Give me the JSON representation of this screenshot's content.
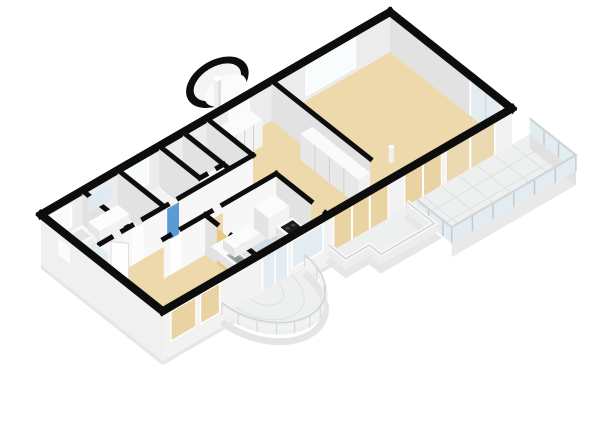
{
  "scene": {
    "type": "floorplan-3d-render",
    "background": "#ffffff",
    "rooms": [
      {
        "id": "living-room",
        "floor": "floor_tan"
      },
      {
        "id": "entry-hall",
        "floor": "floor_tan"
      },
      {
        "id": "corridor",
        "floor": "floor_tan"
      },
      {
        "id": "bedroom-sw",
        "floor": "floor_tan"
      },
      {
        "id": "bathroom",
        "floor": "floor_blue"
      },
      {
        "id": "toilet-room",
        "floor": "floor_white"
      },
      {
        "id": "bedroom-nw",
        "floor": "floor_white"
      },
      {
        "id": "vestibule",
        "floor": "floor_white"
      },
      {
        "id": "storage-room",
        "floor": "floor_dark"
      },
      {
        "id": "kitchen",
        "floor": "floor_blue"
      }
    ],
    "features": [
      "round-turret-balcony",
      "glass-railing-terrace",
      "stepped-terrace",
      "semicircular-balcony",
      "bathtub",
      "shower",
      "vanity",
      "kitchen-counter",
      "sink",
      "fridge",
      "stove",
      "wardrobes"
    ],
    "colors": {
      "wall_cap": "#0d0d0d",
      "wall_inner": "#ececec",
      "wall_mid": "#e2e2e2",
      "wall_face": "#f7f7f7",
      "wall_ext": "#f2f2f2",
      "plinth": "#e6e6e6",
      "floor_tan": "#edd9ab",
      "floor_blue": "#d2dde6",
      "floor_white": "#f3f3f3",
      "floor_dark": "#3a3a3a",
      "balcony_floor": "#eef0ef",
      "balcony_grid": "#dee1e0",
      "glass": "#e3ecf1",
      "glass_tan": "#e9d3a2",
      "frame": "#ffffff",
      "door_white": "#fdfdfd",
      "door_blue": "#5b9bd5",
      "door_tan": "#e9c87f",
      "stove_top": "#1c1c1c",
      "rail_top": "#d2d5d6",
      "fixture_top": "#fbfbfb",
      "fixture_sw": "#e3e3e3",
      "fixture_se": "#efefef"
    }
  }
}
